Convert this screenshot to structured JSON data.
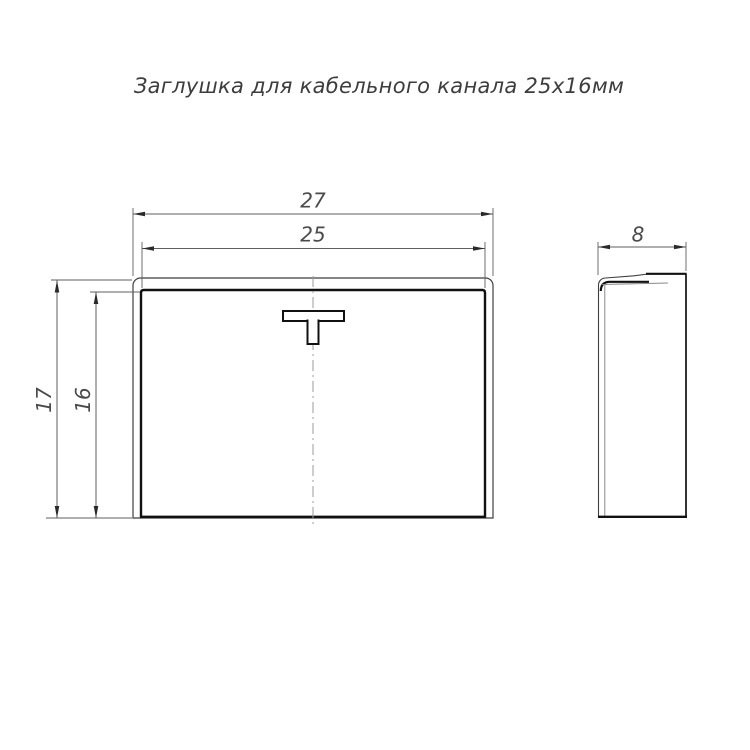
{
  "title": "Заглушка для кабельного канала 25x16мм",
  "dimensions": {
    "outer_width": "27",
    "inner_width": "25",
    "outer_height": "17",
    "inner_height": "16",
    "depth": "8"
  },
  "colors": {
    "background": "#ffffff",
    "outline_thick": "#111111",
    "outline_thin": "#3f3f3f",
    "outline_gray": "#8a8a8a",
    "centerline": "#9b9b9b",
    "dimension_line": "#5f5f5f",
    "arrow": "#2a2a2a",
    "dimension_text": "#4a4a4a",
    "title_text": "#3d3d3d"
  }
}
